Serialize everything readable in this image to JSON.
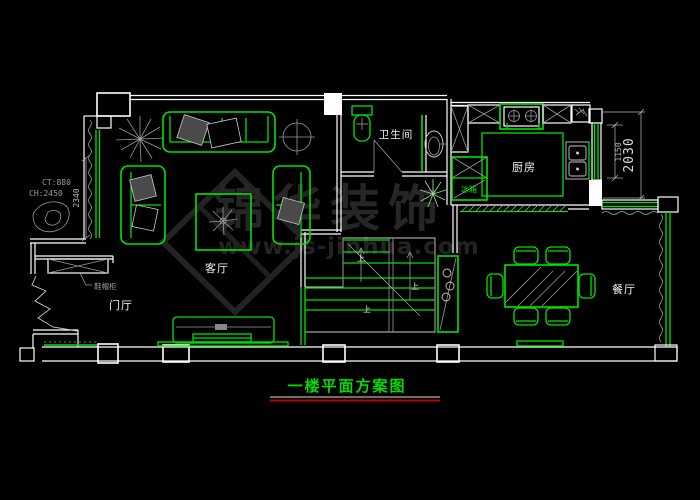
{
  "title": {
    "text": "一楼平面方案图"
  },
  "watermark": {
    "brand": "锦华装饰",
    "url": "www.js-jinhua.com"
  },
  "rooms": {
    "living": "客厅",
    "foyer": "门厅",
    "bath": "卫生间",
    "kitchen": "厨房",
    "dining": "餐厅"
  },
  "labels": {
    "fridge": "冰箱",
    "shoe_cabinet": "鞋帽柜",
    "stairs_up": "上"
  },
  "dims": {
    "left_height": "2340",
    "ct": "CT:880",
    "ch": "CH:2450",
    "kitchen_window": "1150",
    "kitchen_depth": "2030"
  },
  "colors": {
    "wall": "#ffffff",
    "furniture": "#00e400",
    "gray": "#9a9a9a",
    "title": "#00dd00",
    "underline": "#bb0000",
    "watermark": "#262626"
  }
}
